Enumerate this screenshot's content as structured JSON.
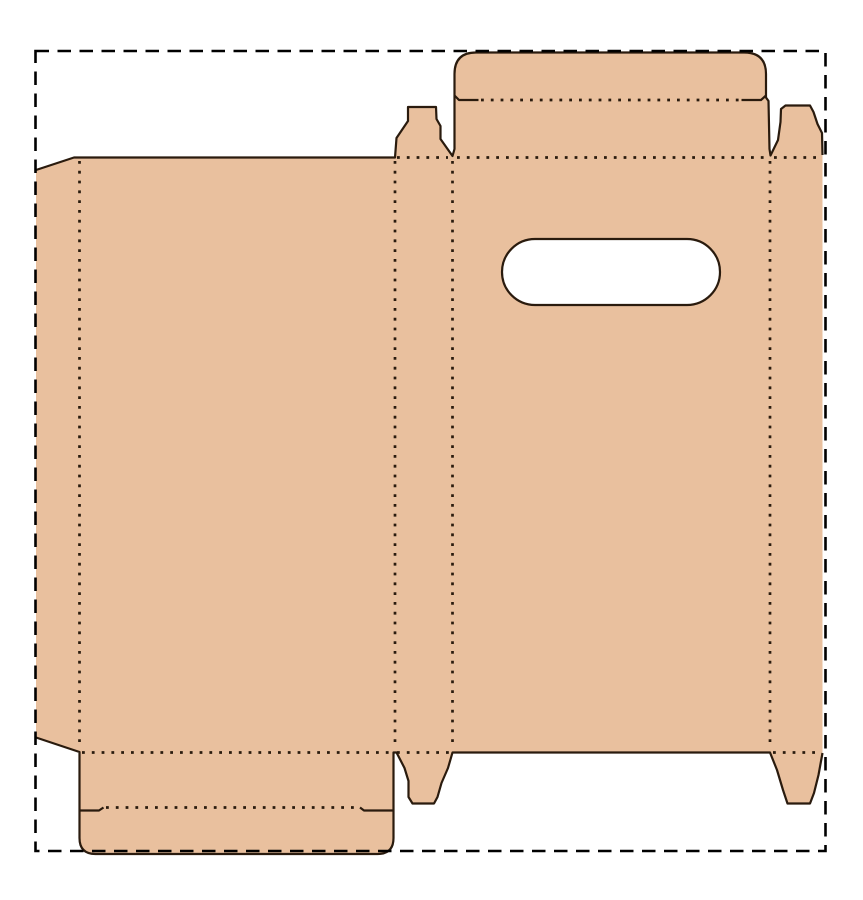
{
  "title": "Carton box dieline template with handle cutout",
  "canvas": {
    "width": 863,
    "height": 900
  },
  "colors": {
    "background": "#ffffff",
    "board_fill": "#e9c09e",
    "cut_line": "#2a1b0e",
    "fold_line": "#2a1b0e",
    "border_line": "#000000",
    "hole_fill": "#ffffff"
  },
  "dieline": {
    "line_legend": {
      "solid": "cut line",
      "dotted": "fold / crease line",
      "dashed": "outer bleed boundary"
    },
    "parts": [
      "outer-bleed-border",
      "glue-flap",
      "back-panel",
      "side-panel-left",
      "front-panel",
      "side-panel-right",
      "top-lid-flap",
      "lid-lip-fold",
      "dust-flap-top-left",
      "dust-flap-top-right",
      "bottom-lid-flap",
      "bottom-lip-fold",
      "dust-flap-bottom-left",
      "dust-flap-bottom-right",
      "handle-cutout"
    ]
  }
}
